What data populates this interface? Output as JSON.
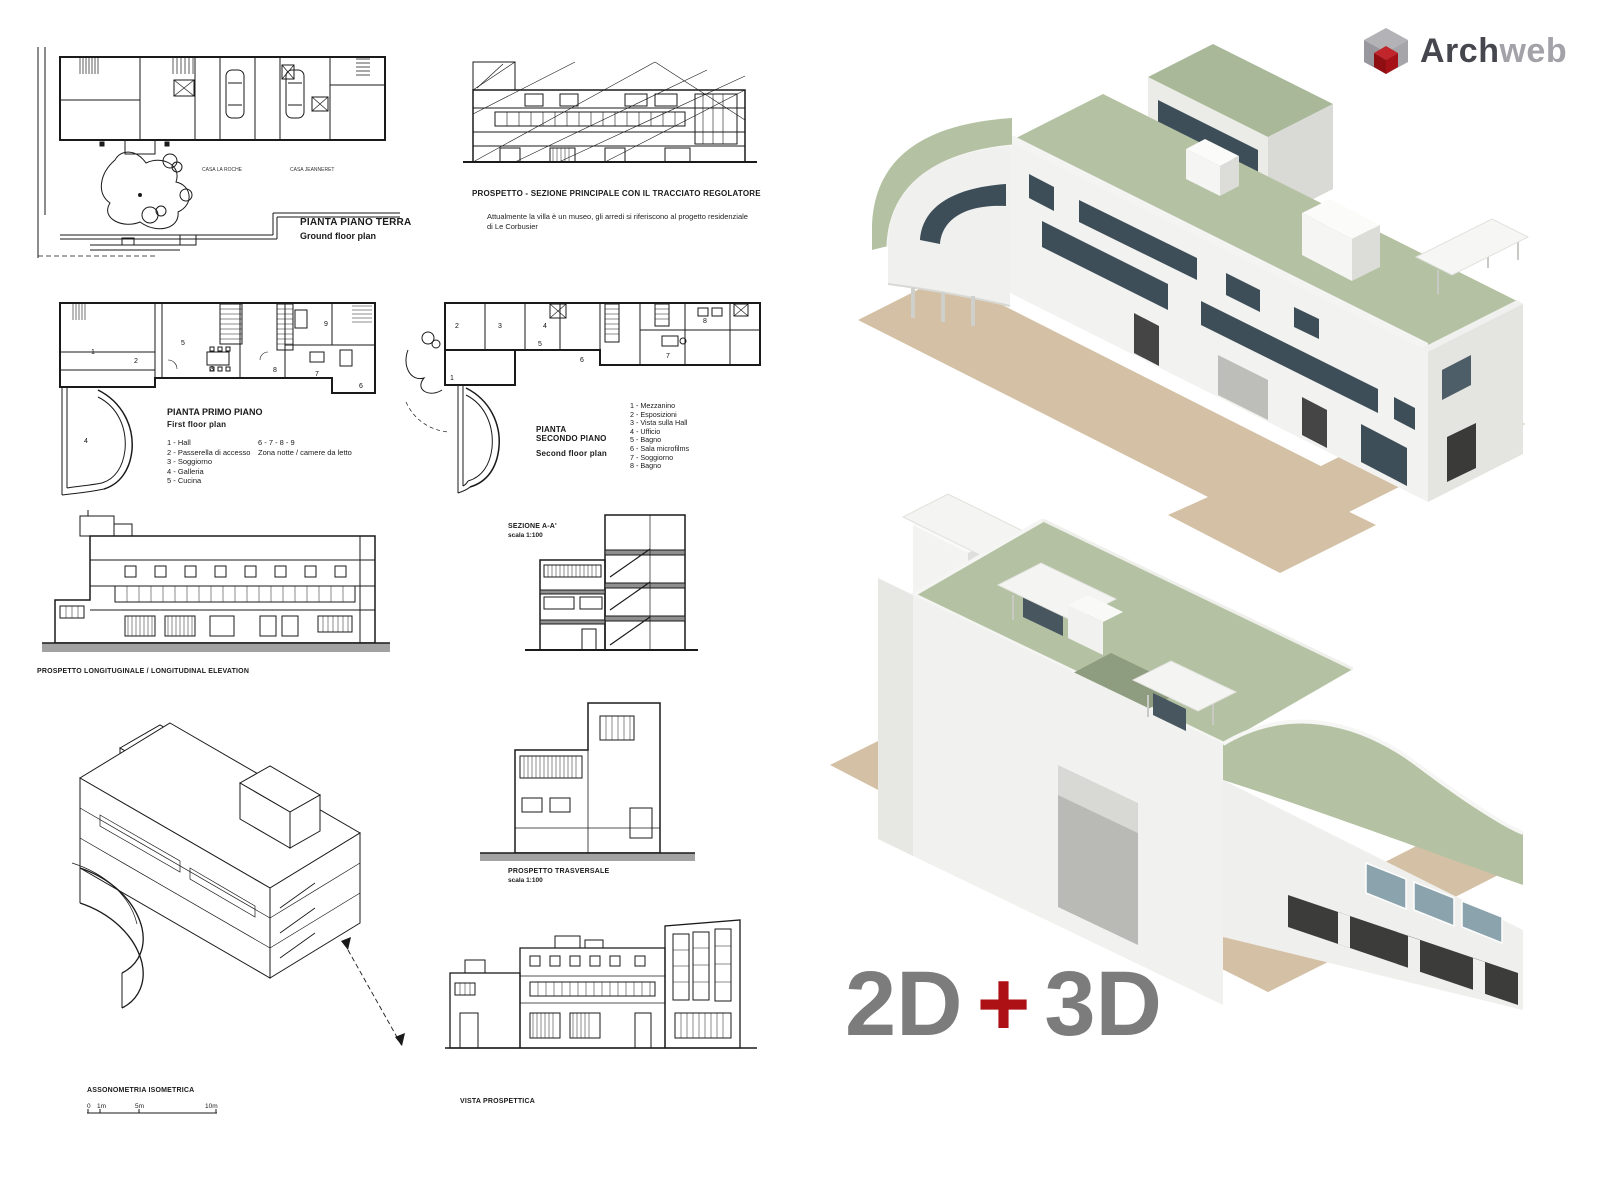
{
  "logo": {
    "brand_part1": "Arch",
    "brand_part2": "web",
    "color_part1": "#46464e",
    "color_part2": "#a2a2a8",
    "icon_gray": "#b3b3b7",
    "icon_red": "#a51116"
  },
  "banner": {
    "left": "2D",
    "plus": "+",
    "right": "3D",
    "text_color": "#7c7c7c",
    "plus_color": "#ad1015"
  },
  "ground_floor": {
    "title": "PIANTA PIANO TERRA",
    "subtitle": "Ground floor plan",
    "house_left": "CASA LA ROCHE",
    "house_right": "CASA JEANNERET"
  },
  "main_elevation": {
    "title": "PROSPETTO - SEZIONE  PRINCIPALE CON IL TRACCIATO REGOLATORE",
    "note_line1": "Attualmente la villa è un museo, gli arredi si riferiscono al progetto residenziale",
    "note_line2": "di Le Corbusier"
  },
  "first_floor": {
    "title": "PIANTA PRIMO PIANO",
    "subtitle": "First floor plan",
    "legend": [
      "1 - Hall",
      "2 - Passerella di accesso",
      "3 - Soggiorno",
      "4 - Galleria",
      "5 - Cucina"
    ],
    "legend_right_line1": "6 - 7 - 8 - 9",
    "legend_right_line2": "Zona notte / camere da letto",
    "rooms": [
      "1",
      "2",
      "3",
      "4",
      "5",
      "6",
      "7",
      "8",
      "9"
    ]
  },
  "second_floor": {
    "title_line1": "PIANTA",
    "title_line2": "SECONDO PIANO",
    "subtitle": "Second floor plan",
    "legend": [
      "1 - Mezzanino",
      "2 - Esposizioni",
      "3 - Vista sulla Hall",
      "4 - Ufficio",
      "5 - Bagno",
      "6 - Sala microfilms",
      "7 - Soggiorno",
      "8 - Bagno"
    ],
    "rooms": [
      "1",
      "2",
      "3",
      "4",
      "5",
      "6",
      "7",
      "8"
    ]
  },
  "longitudinal_elevation": {
    "title": "PROSPETTO LONGITUGINALE  /  LONGITUDINAL ELEVATION"
  },
  "section_aa": {
    "title": "SEZIONE A-A'",
    "scale": "scala 1:100"
  },
  "transverse_elevation": {
    "title": "PROSPETTO TRASVERSALE",
    "scale": "scala 1:100"
  },
  "axonometric": {
    "title": "ASSONOMETRIA ISOMETRICA",
    "scale_ticks": [
      "0",
      "1m",
      "5m",
      "10m"
    ]
  },
  "perspective": {
    "title": "VISTA PROSPETTICA"
  },
  "render_colors": {
    "roof_green": "#b4c2a3",
    "wall_white": "#f2f2f0",
    "wall_shade": "#dededb",
    "window_glass": "#3e4e58",
    "ground_tan": "#d4c0a4"
  }
}
